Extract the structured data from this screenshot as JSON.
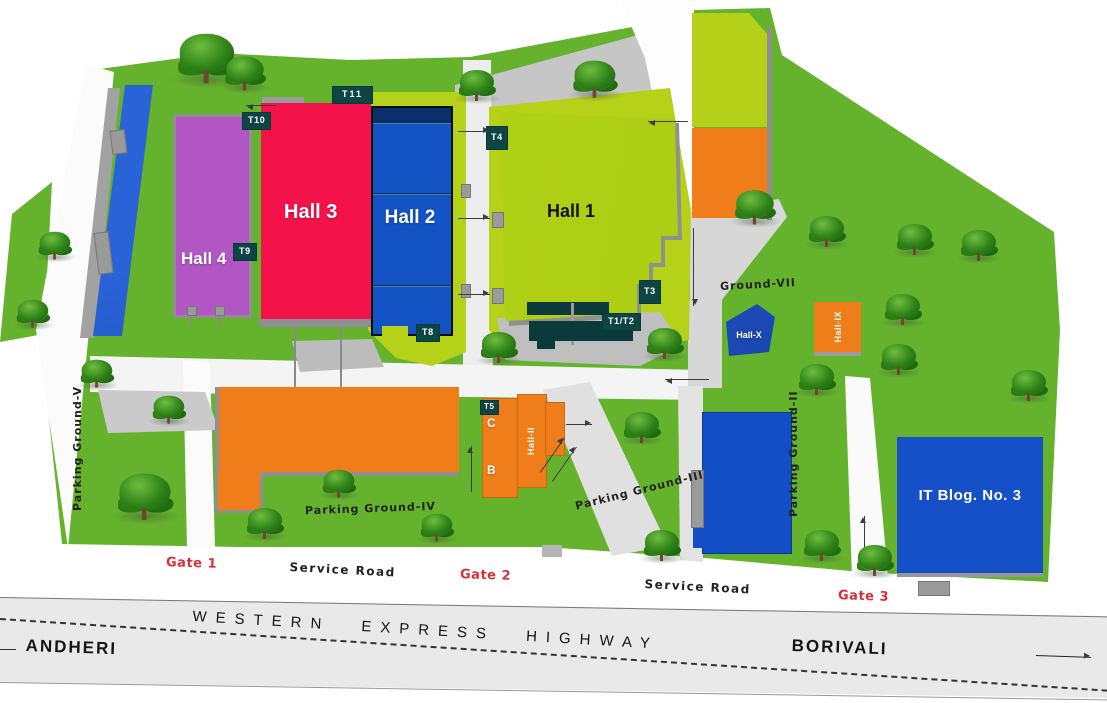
{
  "map": {
    "halls": {
      "hall1": "Hall 1",
      "hall2": "Hall 2",
      "hall3": "Hall 3",
      "hall4": "Hall 4"
    },
    "small_halls": {
      "hall_x": "Hall-X",
      "hall_ix": "Hall-IX",
      "hall_ii": "Hall-II",
      "block_c": "C",
      "block_b": "B"
    },
    "buildings": {
      "it_building": "IT Blog. No. 3"
    },
    "tags": {
      "t1_2": "T1/T2",
      "t3": "T3",
      "t4": "T4",
      "t5": "T5",
      "t8": "T8",
      "t9": "T9",
      "t10": "T10",
      "t11": "T11"
    },
    "grounds": {
      "parking_v": "Parking Ground-V",
      "parking_iv": "Parking Ground-IV",
      "parking_iii": "Parking Ground-III",
      "parking_ii": "Parking Ground-II",
      "ground_vii": "Ground-VII"
    },
    "gates": {
      "gate1": "Gate 1",
      "gate2": "Gate 2",
      "gate3": "Gate 3"
    },
    "roads": {
      "service_west": "Service Road",
      "service_east": "Service Road"
    },
    "highway": {
      "name": "WESTERN EXPRESS HIGHWAY",
      "destination_west": "ANDHERI",
      "destination_east": "BORIVALI"
    },
    "colors": {
      "grass": "#65b32d",
      "ground_light": "#b5d118",
      "hall1": "#aed016",
      "hall2": "#1353c4",
      "hall3": "#f3134a",
      "hall4": "#b156c2",
      "orange": "#ee7d1a",
      "blue_building": "#1650c8",
      "road_gray": "#c6c6c6",
      "tag_bg": "#0d4444",
      "gate_red": "#d63038",
      "highway_gray": "#e9e9e9"
    }
  }
}
